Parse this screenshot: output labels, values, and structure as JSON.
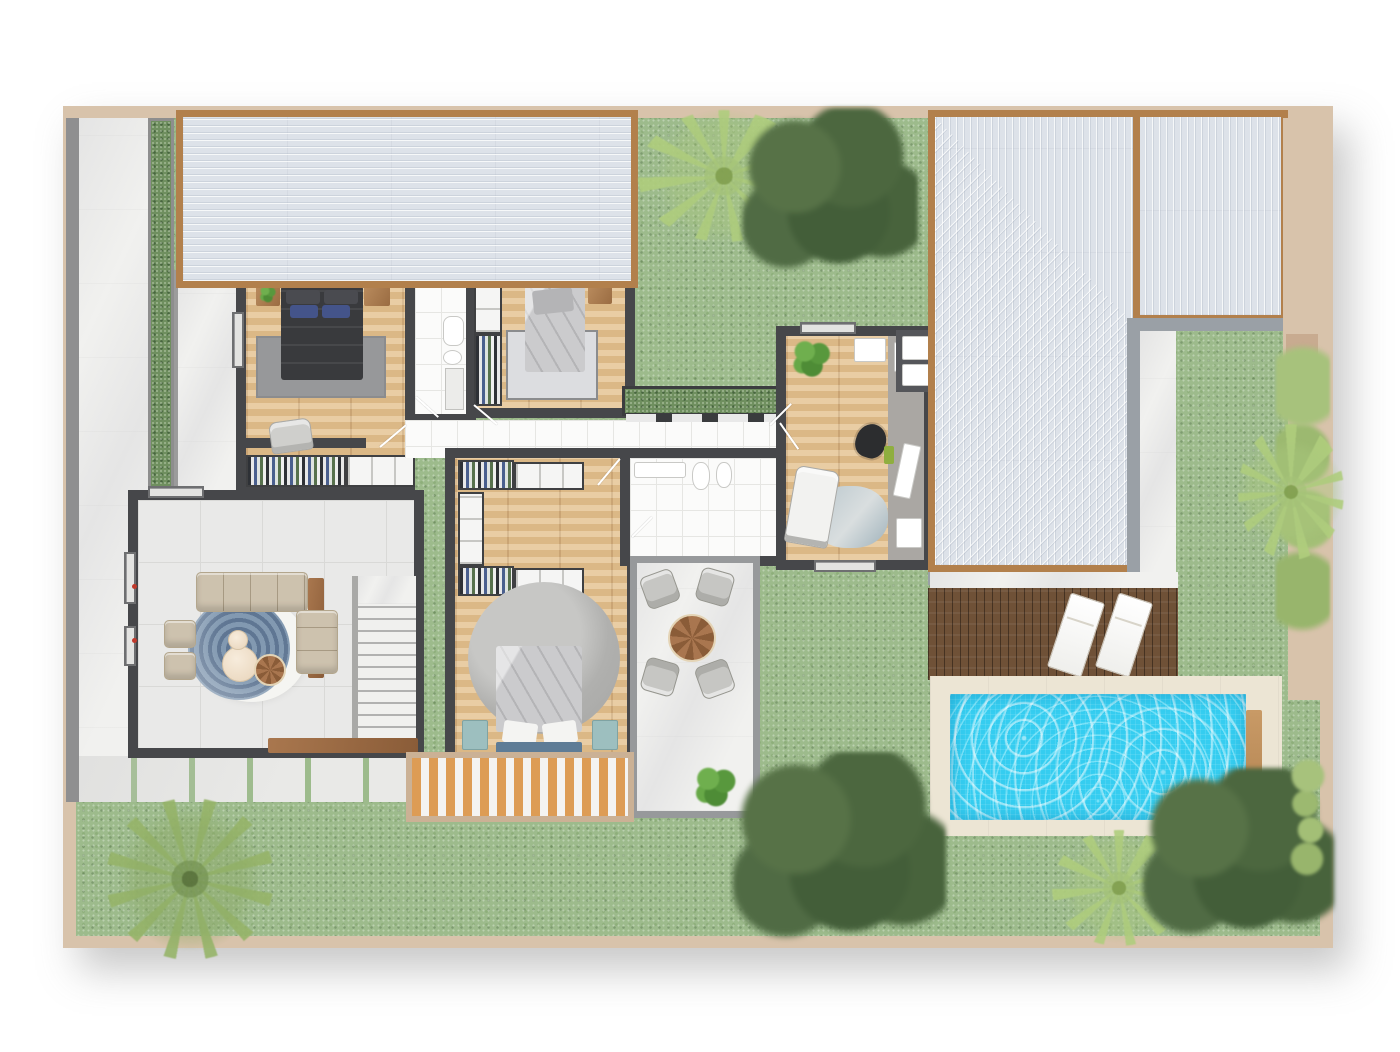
{
  "meta": {
    "title": "Villa ground-floor plan – rendered top view",
    "type": "architectural-floor-plan",
    "visible_text": "none"
  },
  "legend": {
    "rooms": [
      {
        "id": "bedroom-1",
        "label": "Bedroom 1 (double bed, wardrobe, armchair)"
      },
      {
        "id": "ensuite-bathroom",
        "label": "En-suite bathroom (toilet, shower)"
      },
      {
        "id": "bedroom-2",
        "label": "Bedroom 2 (single bed, wardrobe)"
      },
      {
        "id": "hallway",
        "label": "Hallway"
      },
      {
        "id": "master-bedroom",
        "label": "Master bedroom with walk-in closet"
      },
      {
        "id": "bathroom-2",
        "label": "Bathroom (sink, toilet, bidet)"
      },
      {
        "id": "patio",
        "label": "Patio lounge (4 chairs, round table)"
      },
      {
        "id": "office",
        "label": "Home office (desk, lounge chair)"
      },
      {
        "id": "living-room",
        "label": "Living room (L-sofa, round rug)"
      },
      {
        "id": "staircase",
        "label": "Staircase"
      },
      {
        "id": "garage-roof",
        "label": "Flat roof over garage wing"
      },
      {
        "id": "main-roof",
        "label": "Hip roof over main wing"
      },
      {
        "id": "pool",
        "label": "Swimming pool"
      },
      {
        "id": "pool-deck",
        "label": "Pool deck with 2 sun loungers"
      },
      {
        "id": "garden",
        "label": "Garden lawn"
      },
      {
        "id": "driveway",
        "label": "Side driveway / path"
      },
      {
        "id": "entry-walkway",
        "label": "Entry walkway"
      },
      {
        "id": "wood-deck",
        "label": "Slatted deck by master bedroom"
      },
      {
        "id": "stepping-path",
        "label": "Stepping-stone path"
      },
      {
        "id": "courtyard",
        "label": "Courtyard garden with trees"
      },
      {
        "id": "hedge-strip",
        "label": "Hedge planter strip"
      }
    ],
    "colors": {
      "frame": "#d8c3ab",
      "grass": "#9dbb8c",
      "roof": "#dde2e9",
      "roof_fascia": "#b2804c",
      "wall": "#46474a",
      "wood_floor": "#e5c493",
      "marble": "#f1f1ef",
      "pool_water": "#35cdf0",
      "pool_deck_wood": "#6f5137",
      "pool_surround": "#ece5d4",
      "sofa": "#cdc2ae",
      "rug_blue": "#5f7693",
      "nightstand_teal": "#9dbfbf",
      "deck_slat": "#dd9c55"
    }
  }
}
